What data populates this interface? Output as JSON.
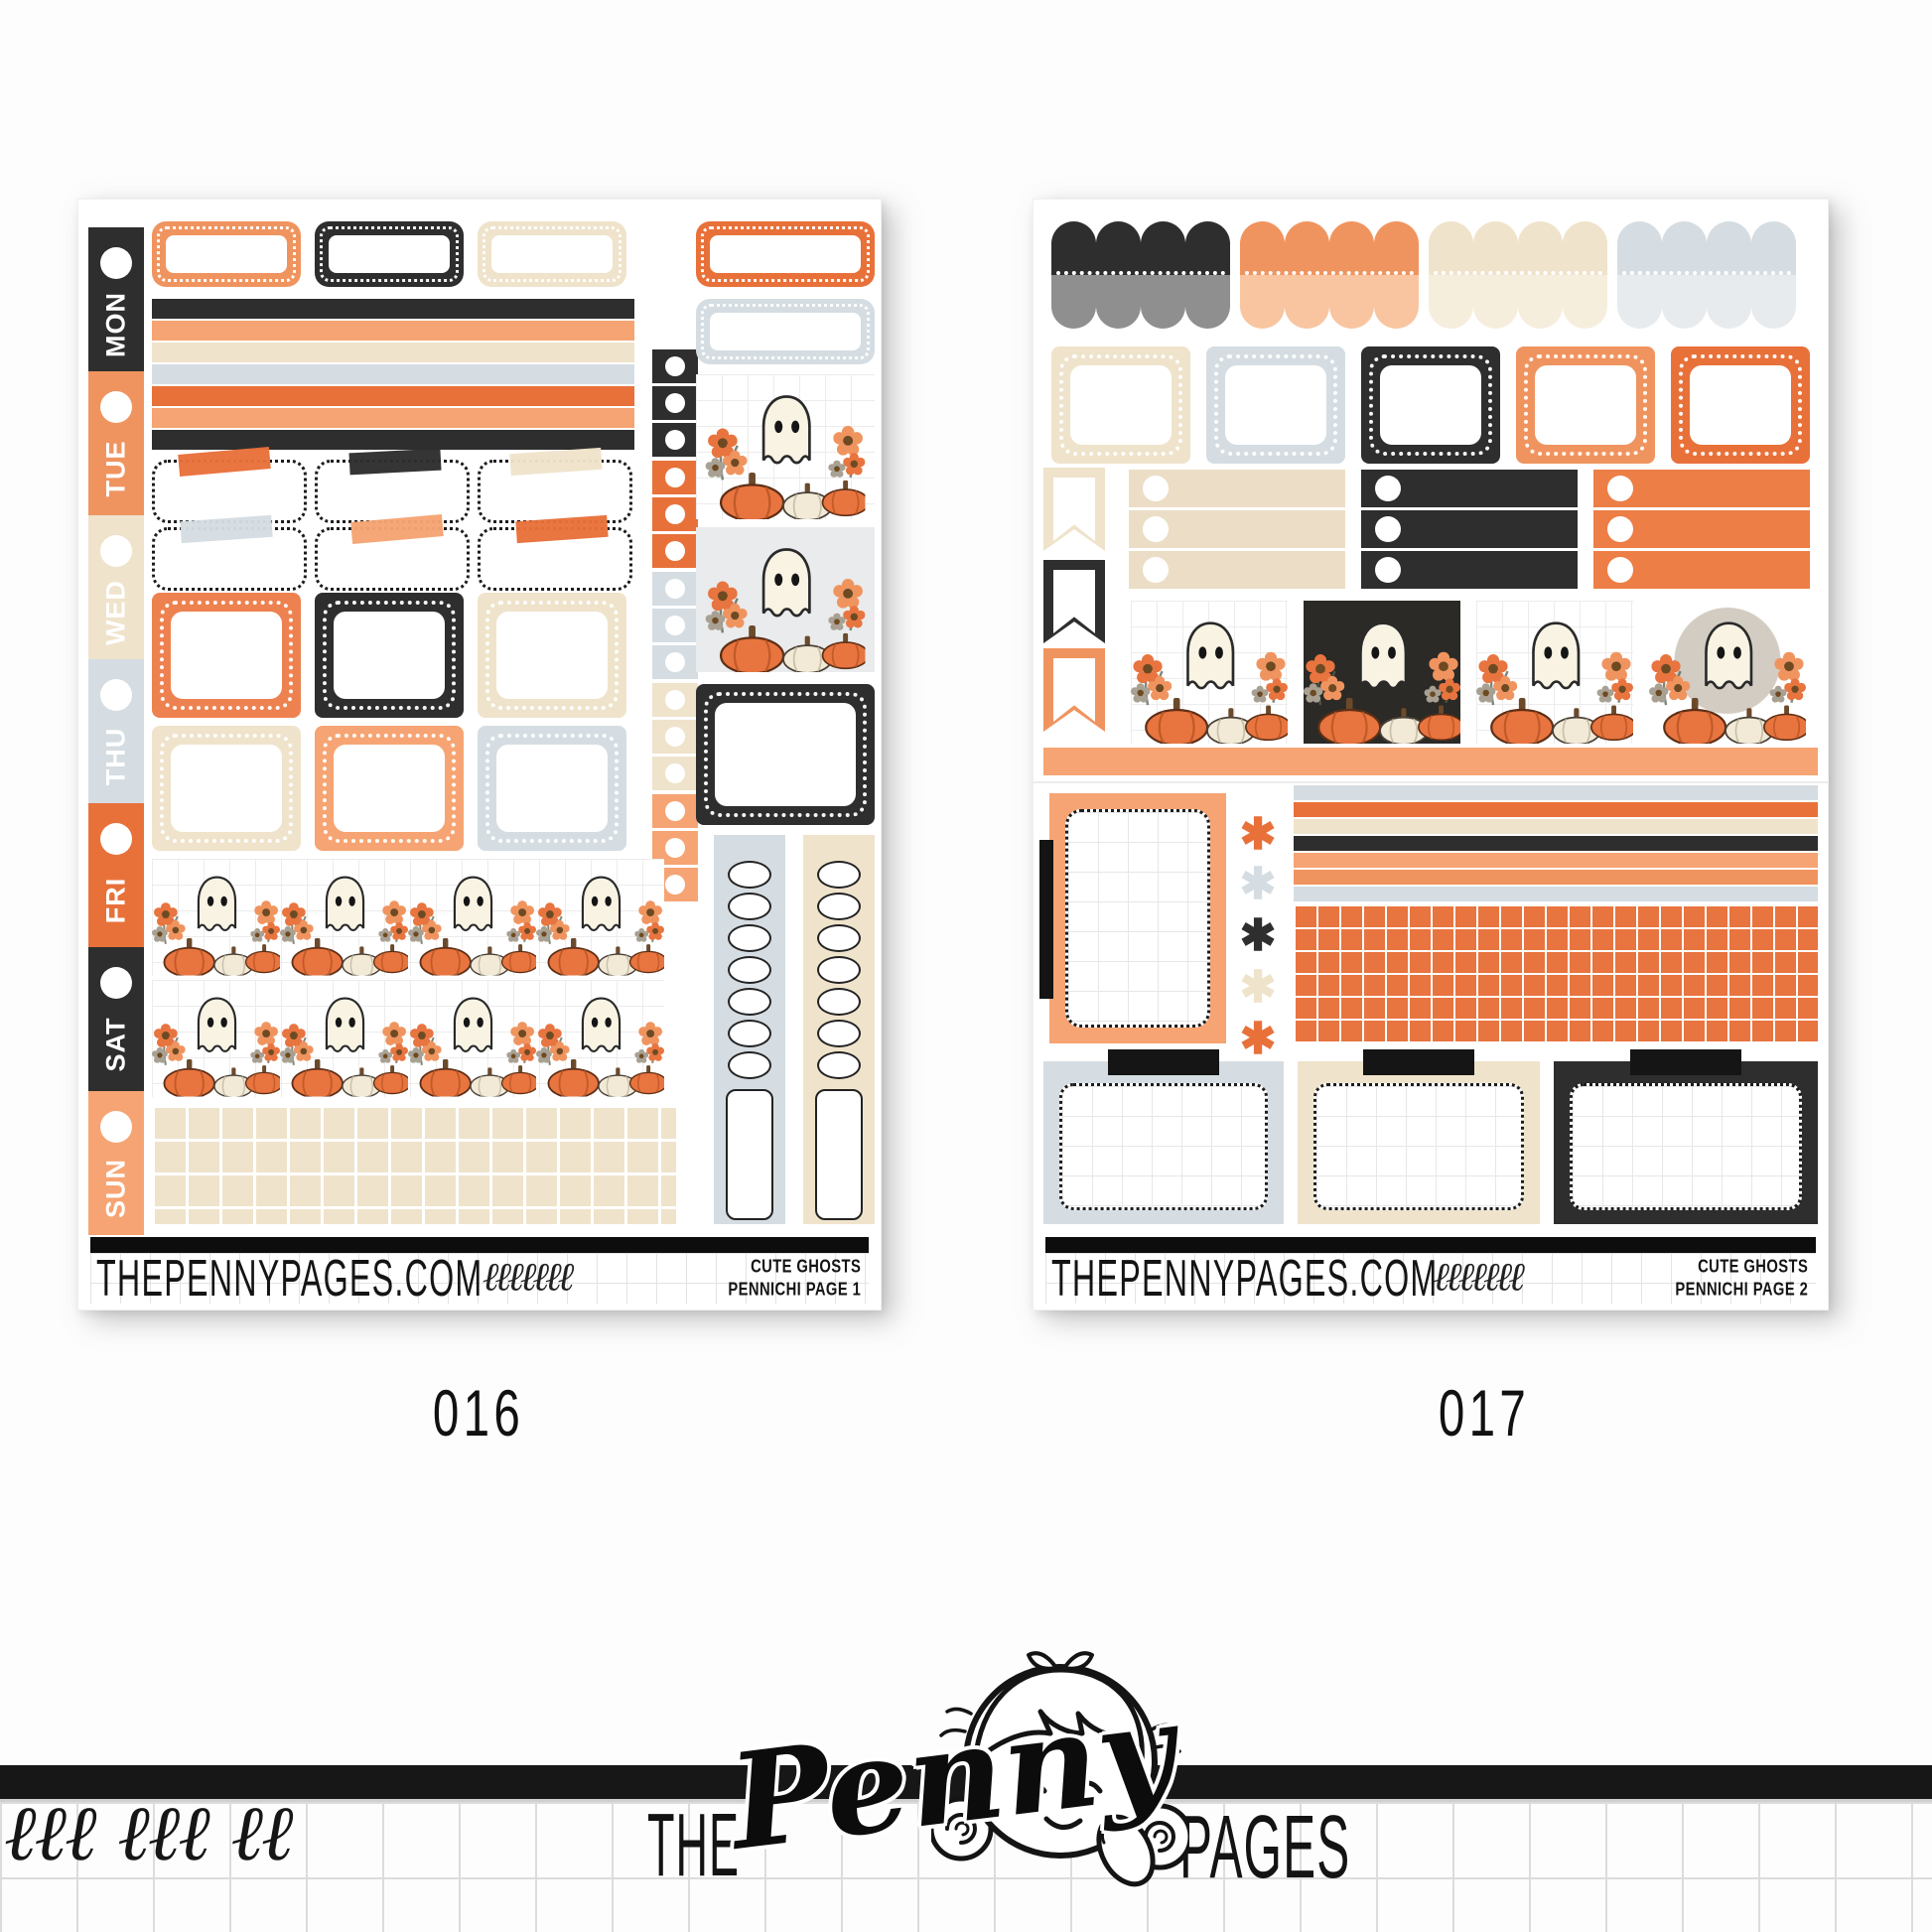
{
  "sheet1": {
    "code": "016",
    "days": [
      "MON",
      "TUE",
      "WED",
      "THU",
      "FRI",
      "SAT",
      "SUN"
    ],
    "footer": {
      "site": "THEPENNYPAGES.COM",
      "collection": "CUTE GHOSTS",
      "page_label": "PENNICHI PAGE 1"
    }
  },
  "sheet2": {
    "code": "017",
    "footer": {
      "site": "THEPENNYPAGES.COM",
      "collection": "CUTE GHOSTS",
      "page_label": "PENNICHI PAGE 2"
    }
  },
  "branding": {
    "word_the": "THE",
    "word_penny": "Penny",
    "word_pages": "PAGES"
  },
  "decor": {
    "squiggle": "ℓℓℓ ℓℓℓ ℓℓ",
    "footer_squiggle": "ℓℓℓℓℓℓℓ",
    "asterisk": "✱"
  },
  "colors": {
    "charcoal": "#2e2e2e",
    "gray": "#8f8f8f",
    "orange": "#f0945f",
    "light_orange": "#f6a473",
    "pale_orange": "#f8c5a0",
    "dark_orange": "#e8713a",
    "beige": "#efe3cb",
    "light_beige": "#f6eedd",
    "gray_blue": "#d5dde2",
    "light_gray_blue": "#e7ebee"
  }
}
